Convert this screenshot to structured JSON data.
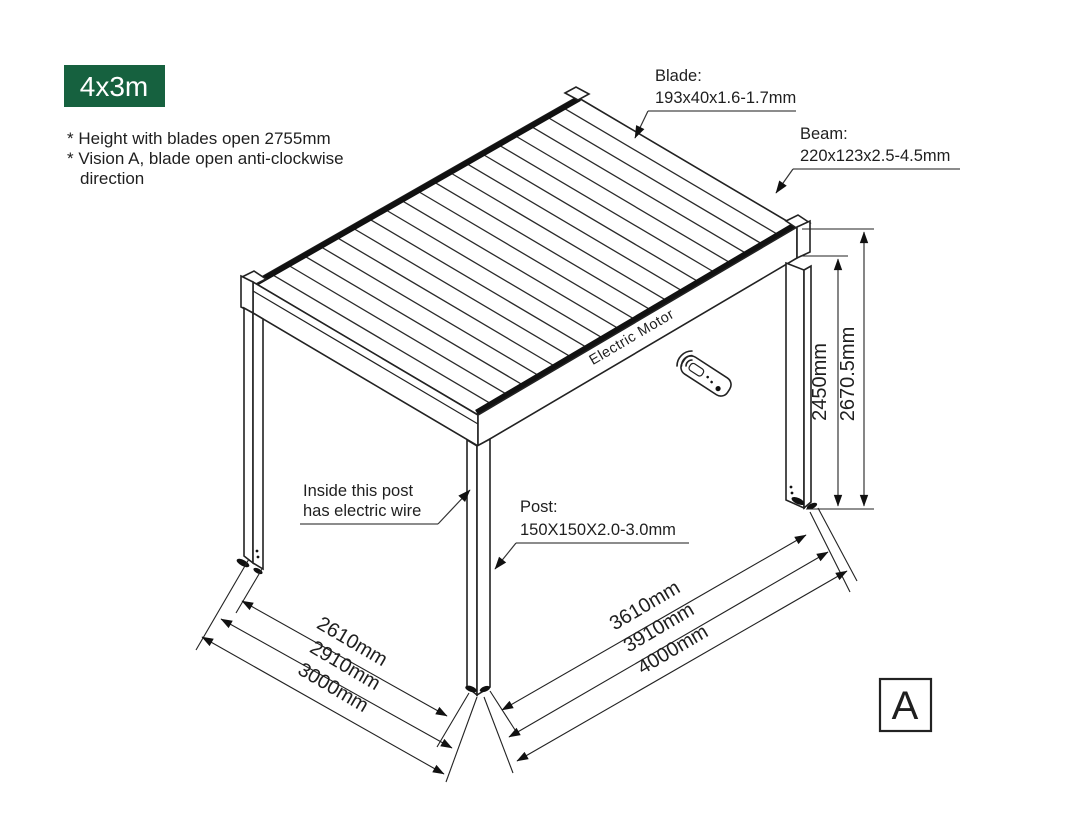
{
  "badge": {
    "label": "4x3m"
  },
  "notes": {
    "line1": "* Height with blades open 2755mm",
    "line2": "* Vision A, blade open anti-clockwise",
    "line3": "direction"
  },
  "callouts": {
    "blade": {
      "title": "Blade:",
      "spec": "193x40x1.6-1.7mm"
    },
    "beam": {
      "title": "Beam:",
      "spec": "220x123x2.5-4.5mm"
    },
    "post": {
      "title": "Post:",
      "spec": "150X150X2.0-3.0mm"
    },
    "wire": {
      "line1": "Inside this post",
      "line2": "has electric wire"
    },
    "motor": "Electric Motor"
  },
  "dimensions": {
    "height_inner": "2450mm",
    "height_outer": "2670.5mm",
    "width_inner": "2610mm",
    "width_mid": "2910mm",
    "width_outer": "3000mm",
    "length_inner": "3610mm",
    "length_mid": "3910mm",
    "length_outer": "4000mm"
  },
  "view_label": "A",
  "icons": {
    "remote": "remote-control-icon",
    "signal": "wireless-signal-icon"
  },
  "colors": {
    "accent_green": "#16613F",
    "line": "#222222"
  }
}
